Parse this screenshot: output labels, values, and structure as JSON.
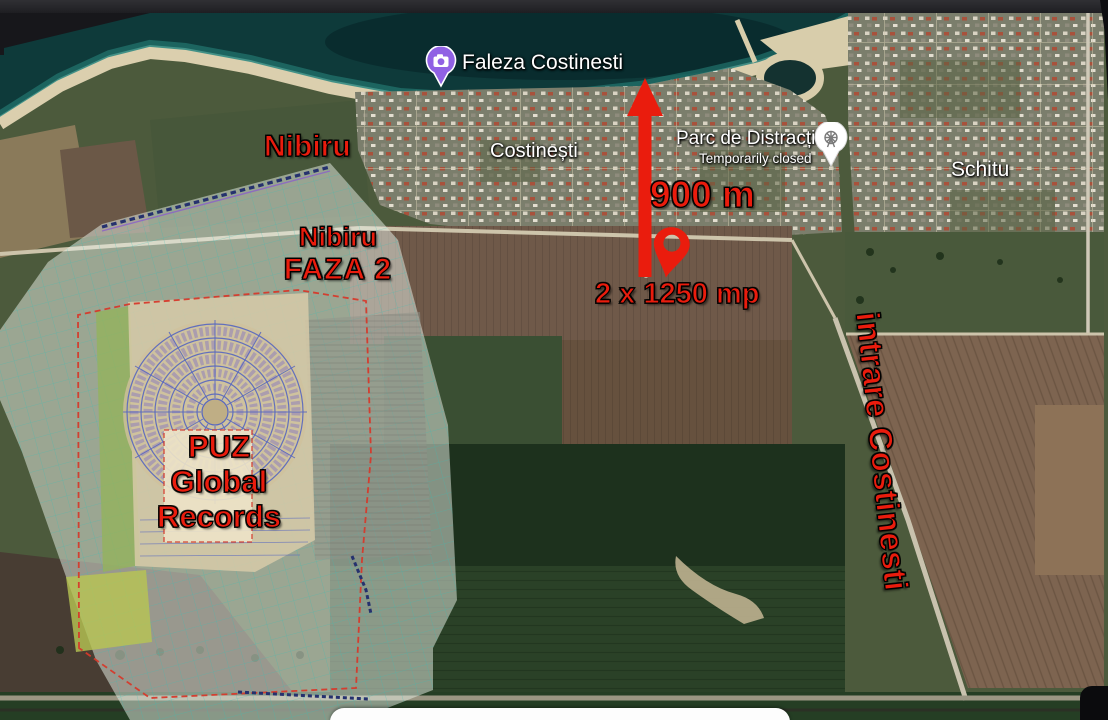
{
  "canvas": {
    "width": 1108,
    "height": 720
  },
  "colors": {
    "annotation_red": "#ea1c0d",
    "label_white": "#ffffff",
    "pin_purple": "#9061e4",
    "sea_deep": "#0e3a3a",
    "beach_sand": "#dbcfae"
  },
  "map_labels": {
    "faleza": "Faleza Costinesti",
    "costinesti": "Costinești",
    "parc_title": "Parc de Distracții",
    "parc_subtitle": "Temporarily closed",
    "schitu": "Schitu"
  },
  "annotations": {
    "nibiru": "Nibiru",
    "faza2_line1": "Nibiru",
    "faza2_line2": "FAZA 2",
    "distance": "900 m",
    "plots": "2 x 1250 mp",
    "puz_line1": "PUZ",
    "puz_line2": "Global",
    "puz_line3": "Records",
    "entrance": "intrare Costinesti"
  },
  "icons": {
    "faleza_pin": "camera-icon",
    "parc_pin": "attraction-pin-icon",
    "plot_marker": "location-pin-icon",
    "distance_arrow": "arrow-up-icon"
  }
}
